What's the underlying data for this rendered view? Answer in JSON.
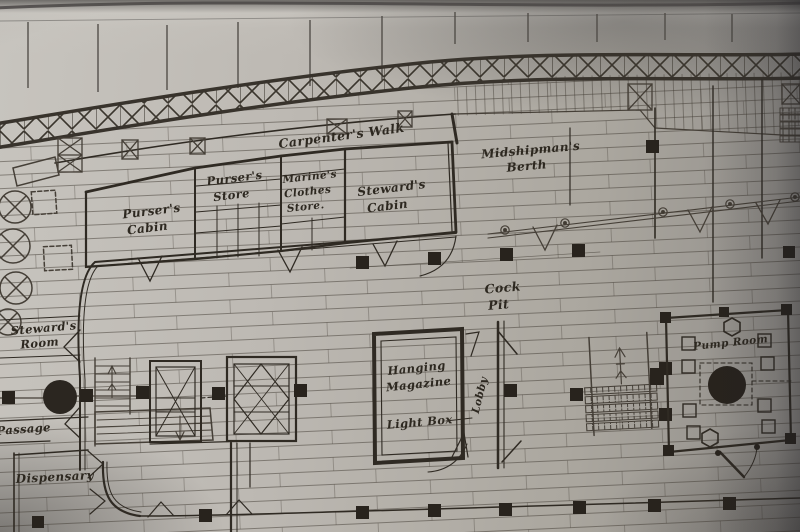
{
  "meta": {
    "description": "Photograph of a hand-drawn ship deck plan (orlop deck) on grey paper"
  },
  "colors": {
    "paper": "#bdb9b3",
    "ink": "#2f2a23",
    "label_ink": "#2d2820"
  },
  "labels": {
    "carpenters_walk": "Carpenter's Walk",
    "pursers_store_l1": "Purser's",
    "pursers_store_l2": "Store",
    "marines_store_l1": "Marine's",
    "marines_store_l2": "Clothes",
    "marines_store_l3": "Store.",
    "stewards_cabin_l1": "Steward's",
    "stewards_cabin_l2": "Cabin",
    "midshipmans_berth_l1": "Midshipman's",
    "midshipmans_berth_l2": "Berth",
    "pursers_cabin_l1": "Purser's",
    "pursers_cabin_l2": "Cabin",
    "cock_pit_l1": "Cock",
    "cock_pit_l2": "Pit",
    "stewards_room_l1": "Steward's",
    "stewards_room_l2": "Room",
    "hanging_magazine_l1": "Hanging",
    "hanging_magazine_l2": "Magazine",
    "light_box": "Light Box",
    "lobby": "Lobby",
    "pump_room": "Pump Room",
    "passage": "Passage",
    "dispensary": "Dispensary"
  }
}
